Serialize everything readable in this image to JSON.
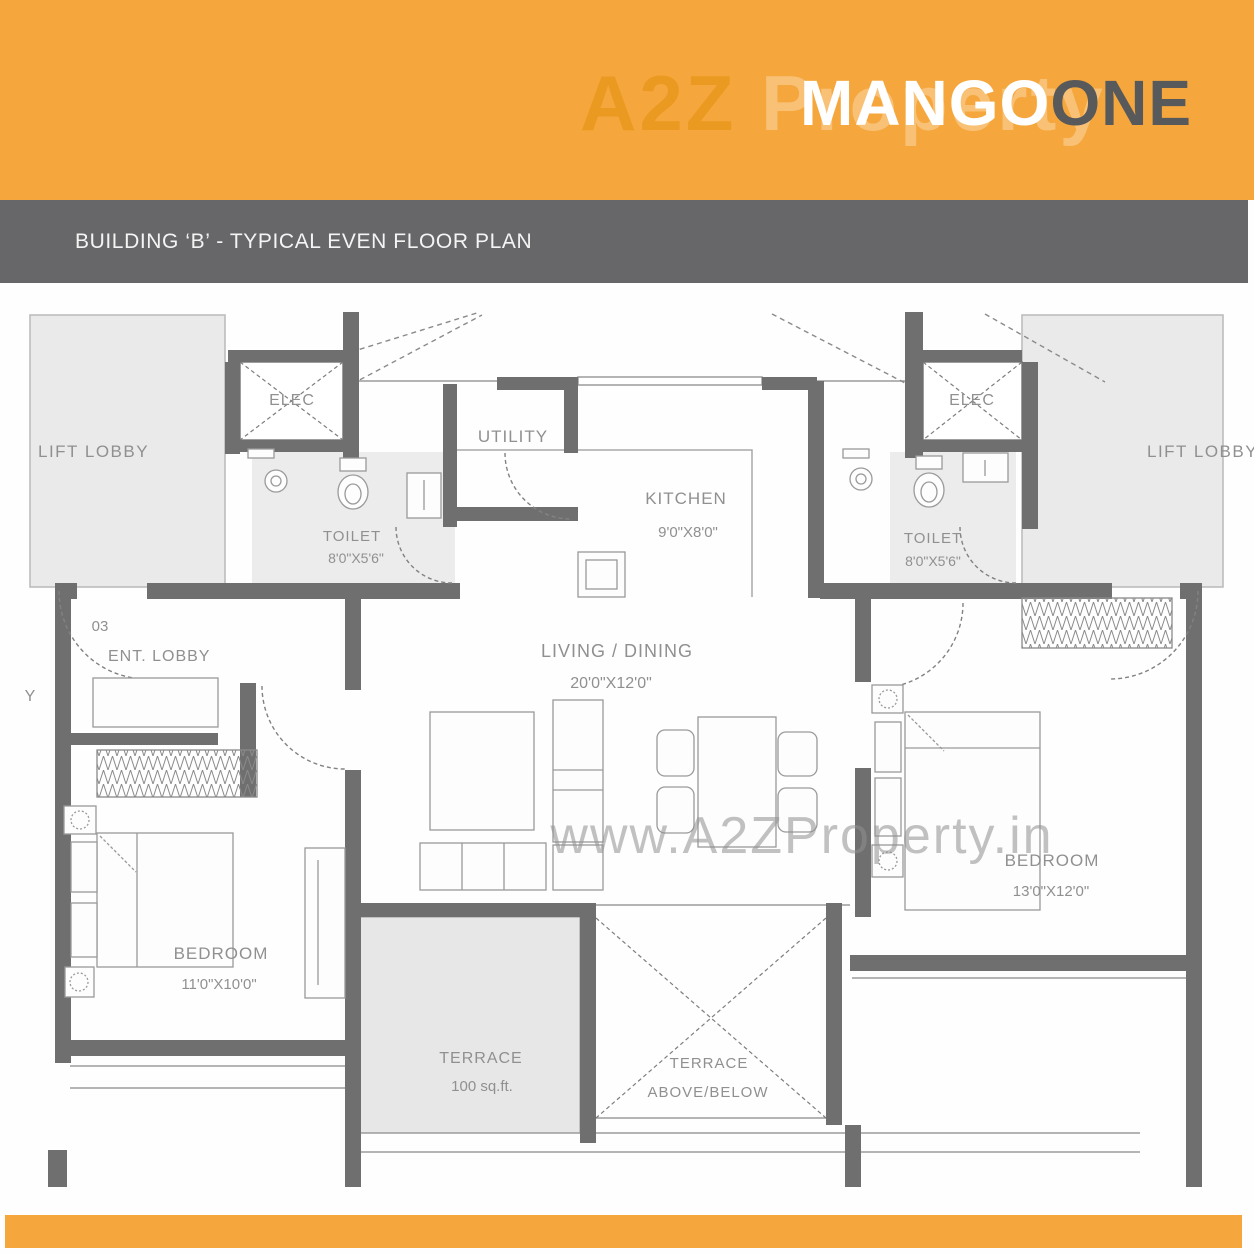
{
  "colors": {
    "orange": "#F5A63C",
    "title_bar_gray": "#67676A",
    "wall_gray": "#6F6F6F",
    "logo_dark": "#58595B",
    "room_fill_gray": "#EAEAEA"
  },
  "header": {
    "brand_first": "MANGO",
    "brand_second": "ONE",
    "watermark_left": "A2Z",
    "watermark_right": " Property"
  },
  "title_bar": {
    "title": "BUILDING ‘B’ - TYPICAL EVEN FLOOR PLAN"
  },
  "watermark": "www.A2ZProperty.in",
  "rooms": {
    "lift_lobby_left": "LIFT LOBBY",
    "lift_lobby_right": "LIFT LOBBY",
    "elec_left": "ELEC",
    "elec_right": "ELEC",
    "utility": "UTILITY",
    "kitchen_name": "KITCHEN",
    "kitchen_dims": "9'0\"X8'0\"",
    "toilet_left_name": "TOILET",
    "toilet_left_dims": "8'0\"X5'6\"",
    "toilet_right_name": "TOILET",
    "toilet_right_dims": "8'0\"X5'6\"",
    "unit_number": "03",
    "ent_lobby": "ENT. LOBBY",
    "living_name": "LIVING / DINING",
    "living_dims": "20'0\"X12'0\"",
    "bedroom_left_name": "BEDROOM",
    "bedroom_left_dims": "11'0\"X10'0\"",
    "bedroom_right_name": "BEDROOM",
    "bedroom_right_dims": "13'0\"X12'0\"",
    "terrace_name": "TERRACE",
    "terrace_area": "100  sq.ft.",
    "terrace_ab_line1": "TERRACE",
    "terrace_ab_line2": "ABOVE/BELOW",
    "edge_label": "Y"
  }
}
